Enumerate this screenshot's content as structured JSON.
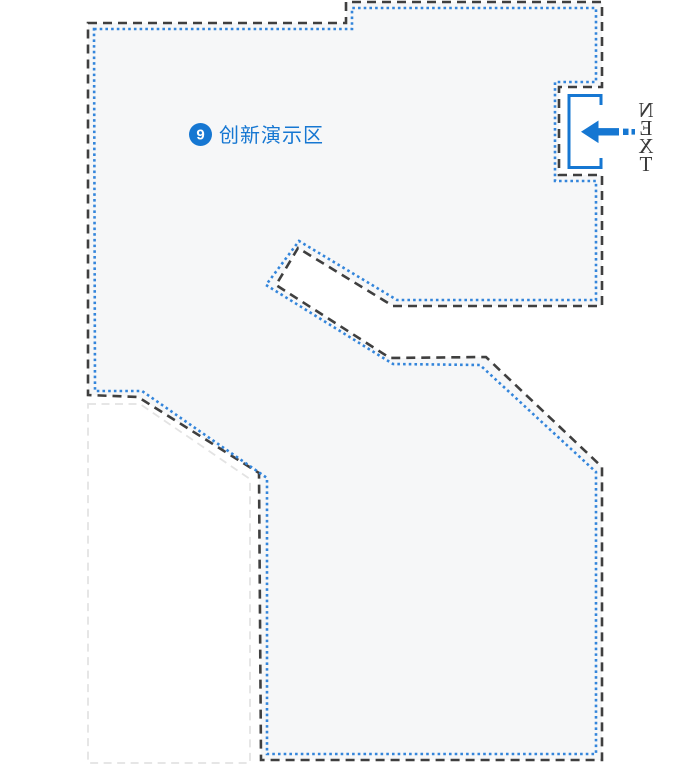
{
  "area": {
    "badge_number": "9",
    "label": "创新演示区"
  },
  "next_indicator": {
    "label": "NEXT",
    "mirrored": true,
    "arrow_direction": "left"
  },
  "colors": {
    "accent_blue": "#1677d2",
    "route_dot_blue": "#3385db",
    "wall_dark": "#3f3f3f",
    "area_fill": "#f6f7f8",
    "neighbor_border": "#e3e3e3",
    "background": "#ffffff",
    "next_text": "#3a3a3a",
    "badge_text": "#ffffff"
  },
  "map": {
    "wall_points": "88,23 346,23 346,2 602,2 602,87 559,87 559,175 602,175 602,306 393,306 298,248 276,285 390,358 486,357 602,467 602,760 261,760 259,473 138,397 88,395",
    "route_points": "94,29 352,29 352,8 596,8 596,82 555,82 555,181 596,181 596,300 397,300 299,241 266,285 393,364 480,365 596,472 596,754 267,754 267,478 142,391 95,391",
    "neighbor_points": "88,404 140,404 250,479 250,763 88,763",
    "door_path": "M 601 105 L 601 95.5 L 569 95.5 L 569 167.5 L 601 167.5 L 601 158"
  }
}
